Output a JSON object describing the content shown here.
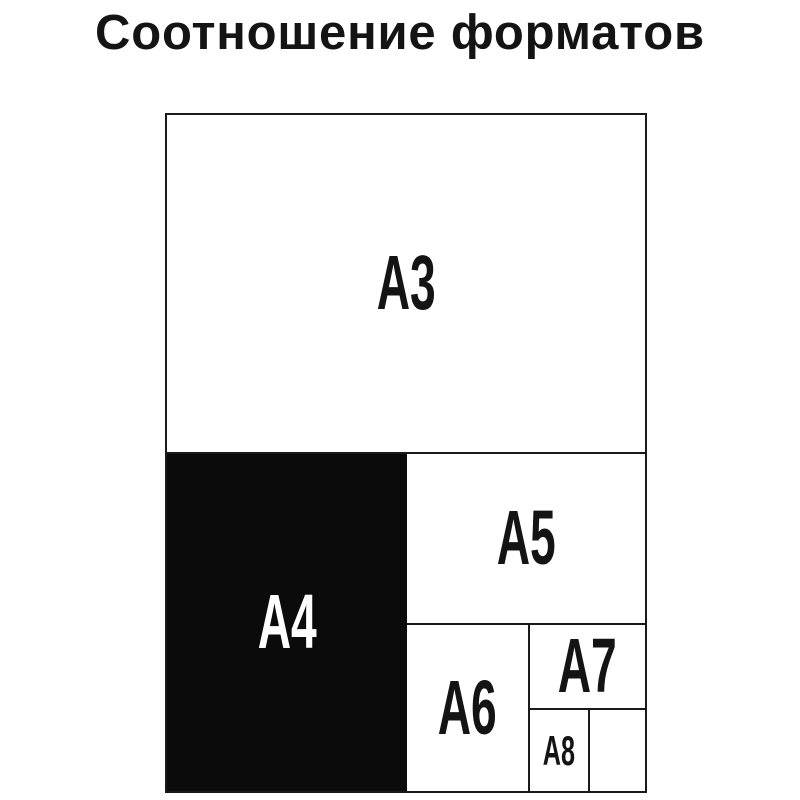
{
  "title": "Соотношение форматов",
  "colors": {
    "background": "#ffffff",
    "line": "#1a1a1a",
    "text": "#141414",
    "a4_fill": "#0b0b0b",
    "a4_text": "#ffffff"
  },
  "diagram": {
    "type": "paper-format-size-comparison",
    "highlighted_format": "A4",
    "formats": [
      {
        "id": "A3",
        "label": "A3",
        "fill": "white"
      },
      {
        "id": "A4",
        "label": "A4",
        "fill": "black"
      },
      {
        "id": "A5",
        "label": "A5",
        "fill": "white"
      },
      {
        "id": "A6",
        "label": "A6",
        "fill": "white"
      },
      {
        "id": "A7",
        "label": "A7",
        "fill": "white"
      },
      {
        "id": "A8",
        "label": "A8",
        "fill": "white"
      },
      {
        "id": "A8-empty",
        "label": "",
        "fill": "white"
      }
    ]
  }
}
